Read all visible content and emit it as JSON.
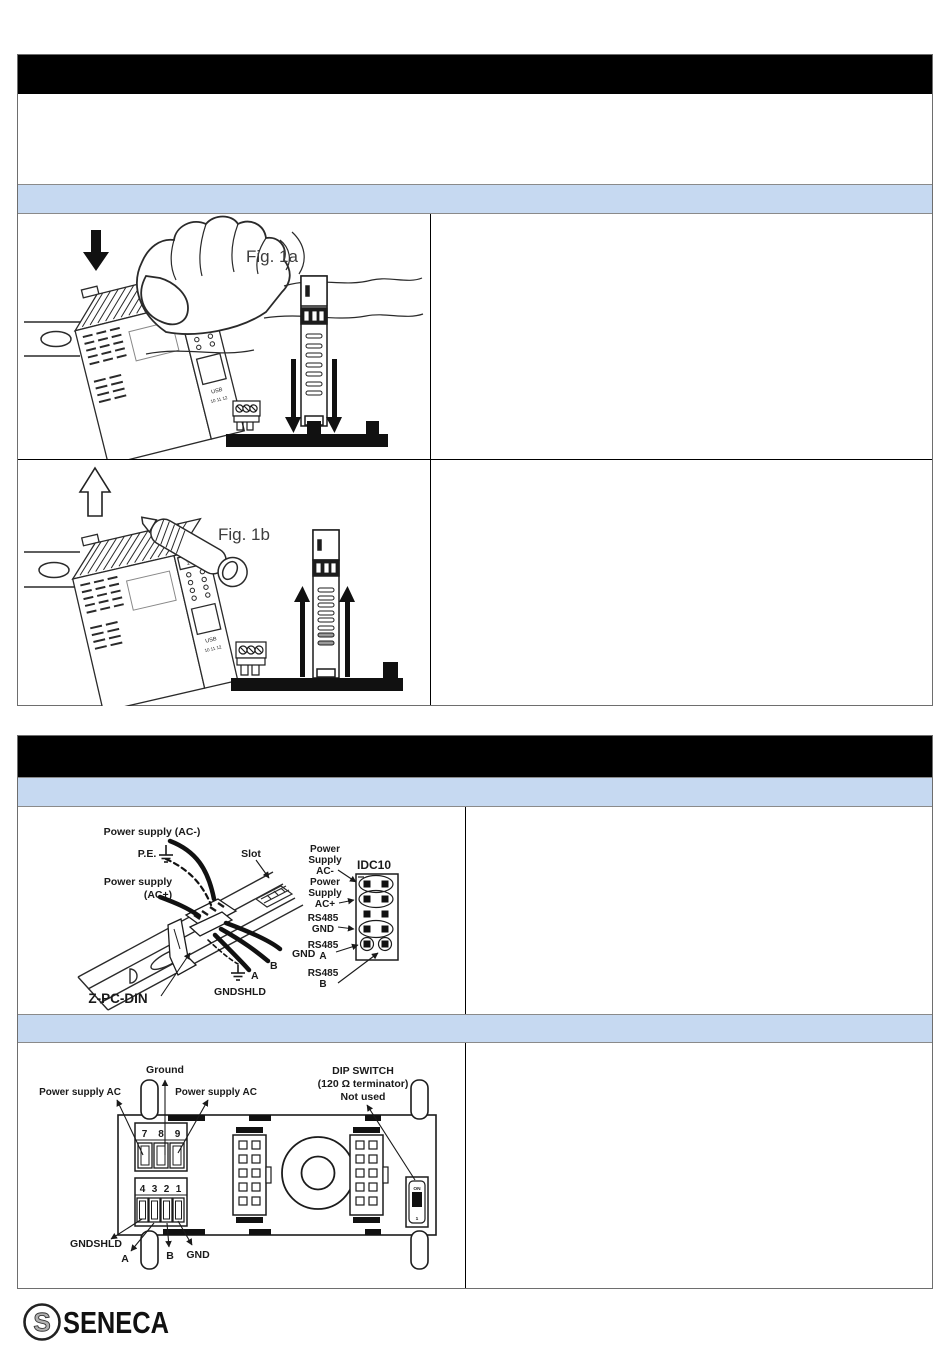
{
  "page": {
    "background": "#ffffff",
    "accent_blue": "#c6d9f1",
    "bar_black": "#000000",
    "line_color": "#222222"
  },
  "section_installation": {
    "title": "",
    "body": "",
    "subheader": ""
  },
  "figures": {
    "fig1a_label": "Fig. 1a",
    "fig1b_label": "Fig. 1b"
  },
  "module_panel": {
    "top_terminals": "1 2 3",
    "usb": "USB",
    "bottom_terminals": "10 11 12"
  },
  "section_connections": {
    "title": "",
    "subheader_power": "",
    "subheader_rear": ""
  },
  "wiring": {
    "labels": {
      "power_ac_minus": "Power supply (AC-)",
      "pe": "P.E.",
      "slot": "Slot",
      "power_ac_plus_line1": "Power supply",
      "power_ac_plus_line2": "(AC+)",
      "gnd": "GND",
      "b": "B",
      "a": "A",
      "gndshld": "GNDSHLD",
      "din_clip": "Z-PC-DIN"
    },
    "idc10": {
      "title": "IDC10",
      "pin_labels": [
        [
          "Power",
          "Supply",
          "AC-"
        ],
        [
          "Power",
          "Supply",
          "AC+"
        ],
        [
          "RS485",
          "GND"
        ],
        [
          "RS485",
          "A"
        ],
        [
          "RS485",
          "B"
        ]
      ]
    }
  },
  "rear": {
    "labels": {
      "ground": "Ground",
      "power_ac_left": "Power supply AC",
      "power_ac_right": "Power supply AC",
      "dip_line1": "DIP SWITCH",
      "dip_line2": "(120 Ω terminator)",
      "dip_line3": "Not used",
      "gndshld": "GNDSHLD",
      "a": "A",
      "b": "B",
      "gnd": "GND",
      "dip_on": "ON",
      "dip_pos": "1"
    },
    "terminals_top": [
      "7",
      "8",
      "9"
    ],
    "terminals_bottom": [
      "4",
      "3",
      "2",
      "1"
    ]
  },
  "footer": {
    "brand": "SENECA"
  }
}
